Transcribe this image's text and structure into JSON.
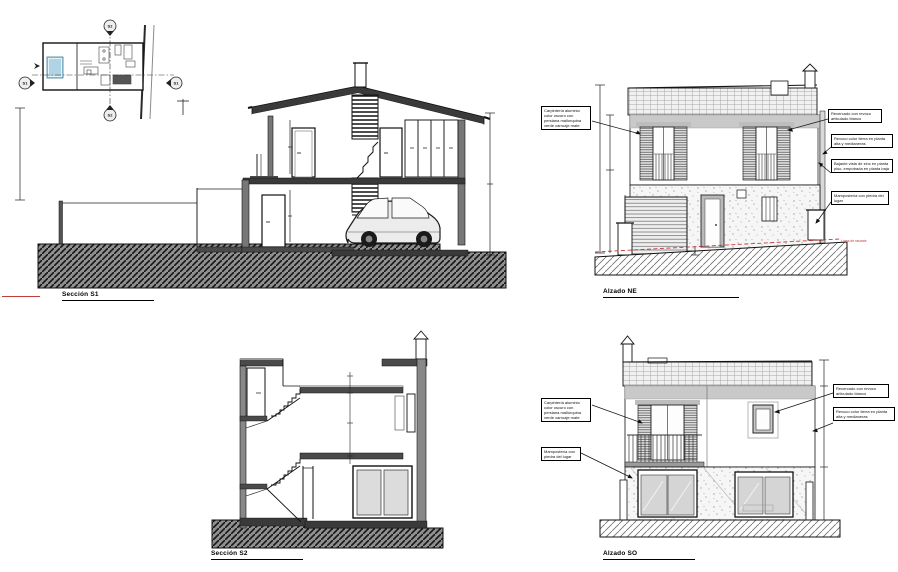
{
  "drawings": {
    "seccion_s1": {
      "label": "Sección S1"
    },
    "seccion_s2": {
      "label": "Sección S2"
    },
    "alzado_ne": {
      "label": "Alzado NE",
      "rasante_note": "Línea de rasante"
    },
    "alzado_so": {
      "label": "Alzado SO"
    }
  },
  "site_plan": {
    "marker_s1": "S1",
    "marker_s2": "S2"
  },
  "annotations": {
    "carpinteria": "Carpintería aluminio color oscuro con persiana mallorquina verde carruaje mate",
    "recercado": "Recercado con revoco articulado blanco",
    "revoco_tierra": "Revoco color tierra en planta alta y medianeras",
    "bajante": "Bajante vista de zinc en planta piso, empotrada en planta baja",
    "mamposteria": "Mampostería con piedra del lugar"
  },
  "colors": {
    "line": "#1a1a1a",
    "accent_red": "#c23b3b",
    "pool": "#aed4e6"
  }
}
